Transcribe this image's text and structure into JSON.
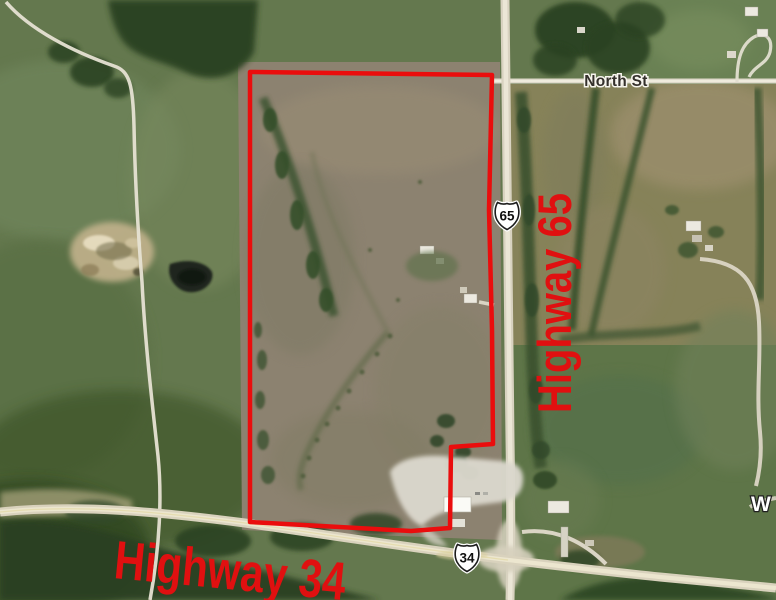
{
  "map": {
    "street_label": "North St",
    "partial_street_label": "W",
    "shields": [
      {
        "number": "65"
      },
      {
        "number": "34"
      }
    ],
    "overlay_labels": [
      {
        "text": "Highway 65"
      },
      {
        "text": "Highway 34"
      }
    ],
    "boundary": {
      "points": "250,72 492,75 489,210 492,330 493,444 451,447 450,528 411,531 250,522"
    },
    "colors": {
      "boundary_red": "#ea0d0d",
      "label_red": "#e01010",
      "shield_fill": "#ffffff",
      "shield_border": "#1c1c1c",
      "street_label_ink": "#34302b",
      "street_label_halo": "#f7f5ee",
      "road_light": "#e9e4d3",
      "field_green": "#64784e",
      "parcel_tan": "#8c8270",
      "tree_dark": "#2c4322"
    }
  }
}
